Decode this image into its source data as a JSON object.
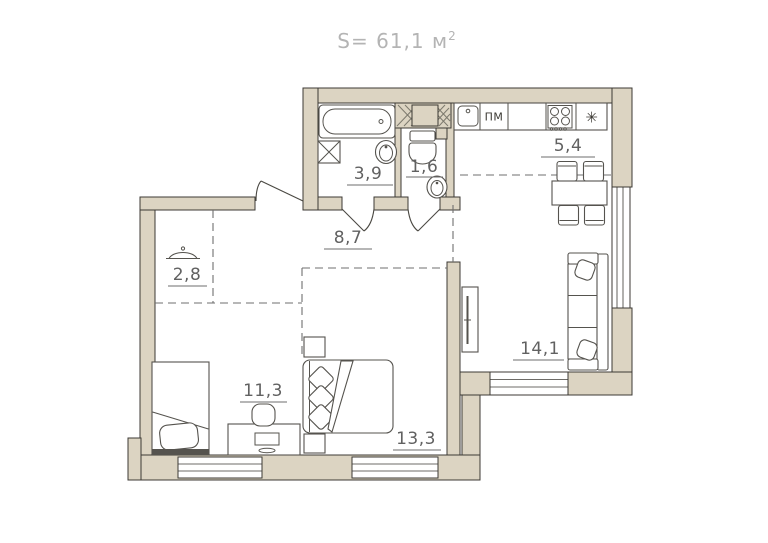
{
  "title": {
    "prefix": "S= 61,1 м",
    "sup": "2"
  },
  "rooms": {
    "bathroom": {
      "name": "bathroom",
      "area": "3,9"
    },
    "wc": {
      "name": "wc",
      "area": "1,6"
    },
    "kitchen": {
      "name": "kitchen",
      "area": "5,4"
    },
    "hallway": {
      "name": "hallway",
      "area": "8,7"
    },
    "wardrobe": {
      "name": "wardrobe",
      "area": "2,8"
    },
    "living": {
      "name": "living-room",
      "area": "14,1"
    },
    "bedroom1": {
      "name": "bedroom-1",
      "area": "11,3"
    },
    "bedroom2": {
      "name": "bedroom-2",
      "area": "13,3"
    }
  },
  "kitchen_fixtures": {
    "dishwasher_label": "ПМ",
    "fridge_symbol": "✳"
  },
  "colors": {
    "wall_fill": "#dcd4c2",
    "outline": "#3c3a34",
    "label": "#616161",
    "title": "#b4b4b4",
    "dash": "#6f6f6f"
  }
}
